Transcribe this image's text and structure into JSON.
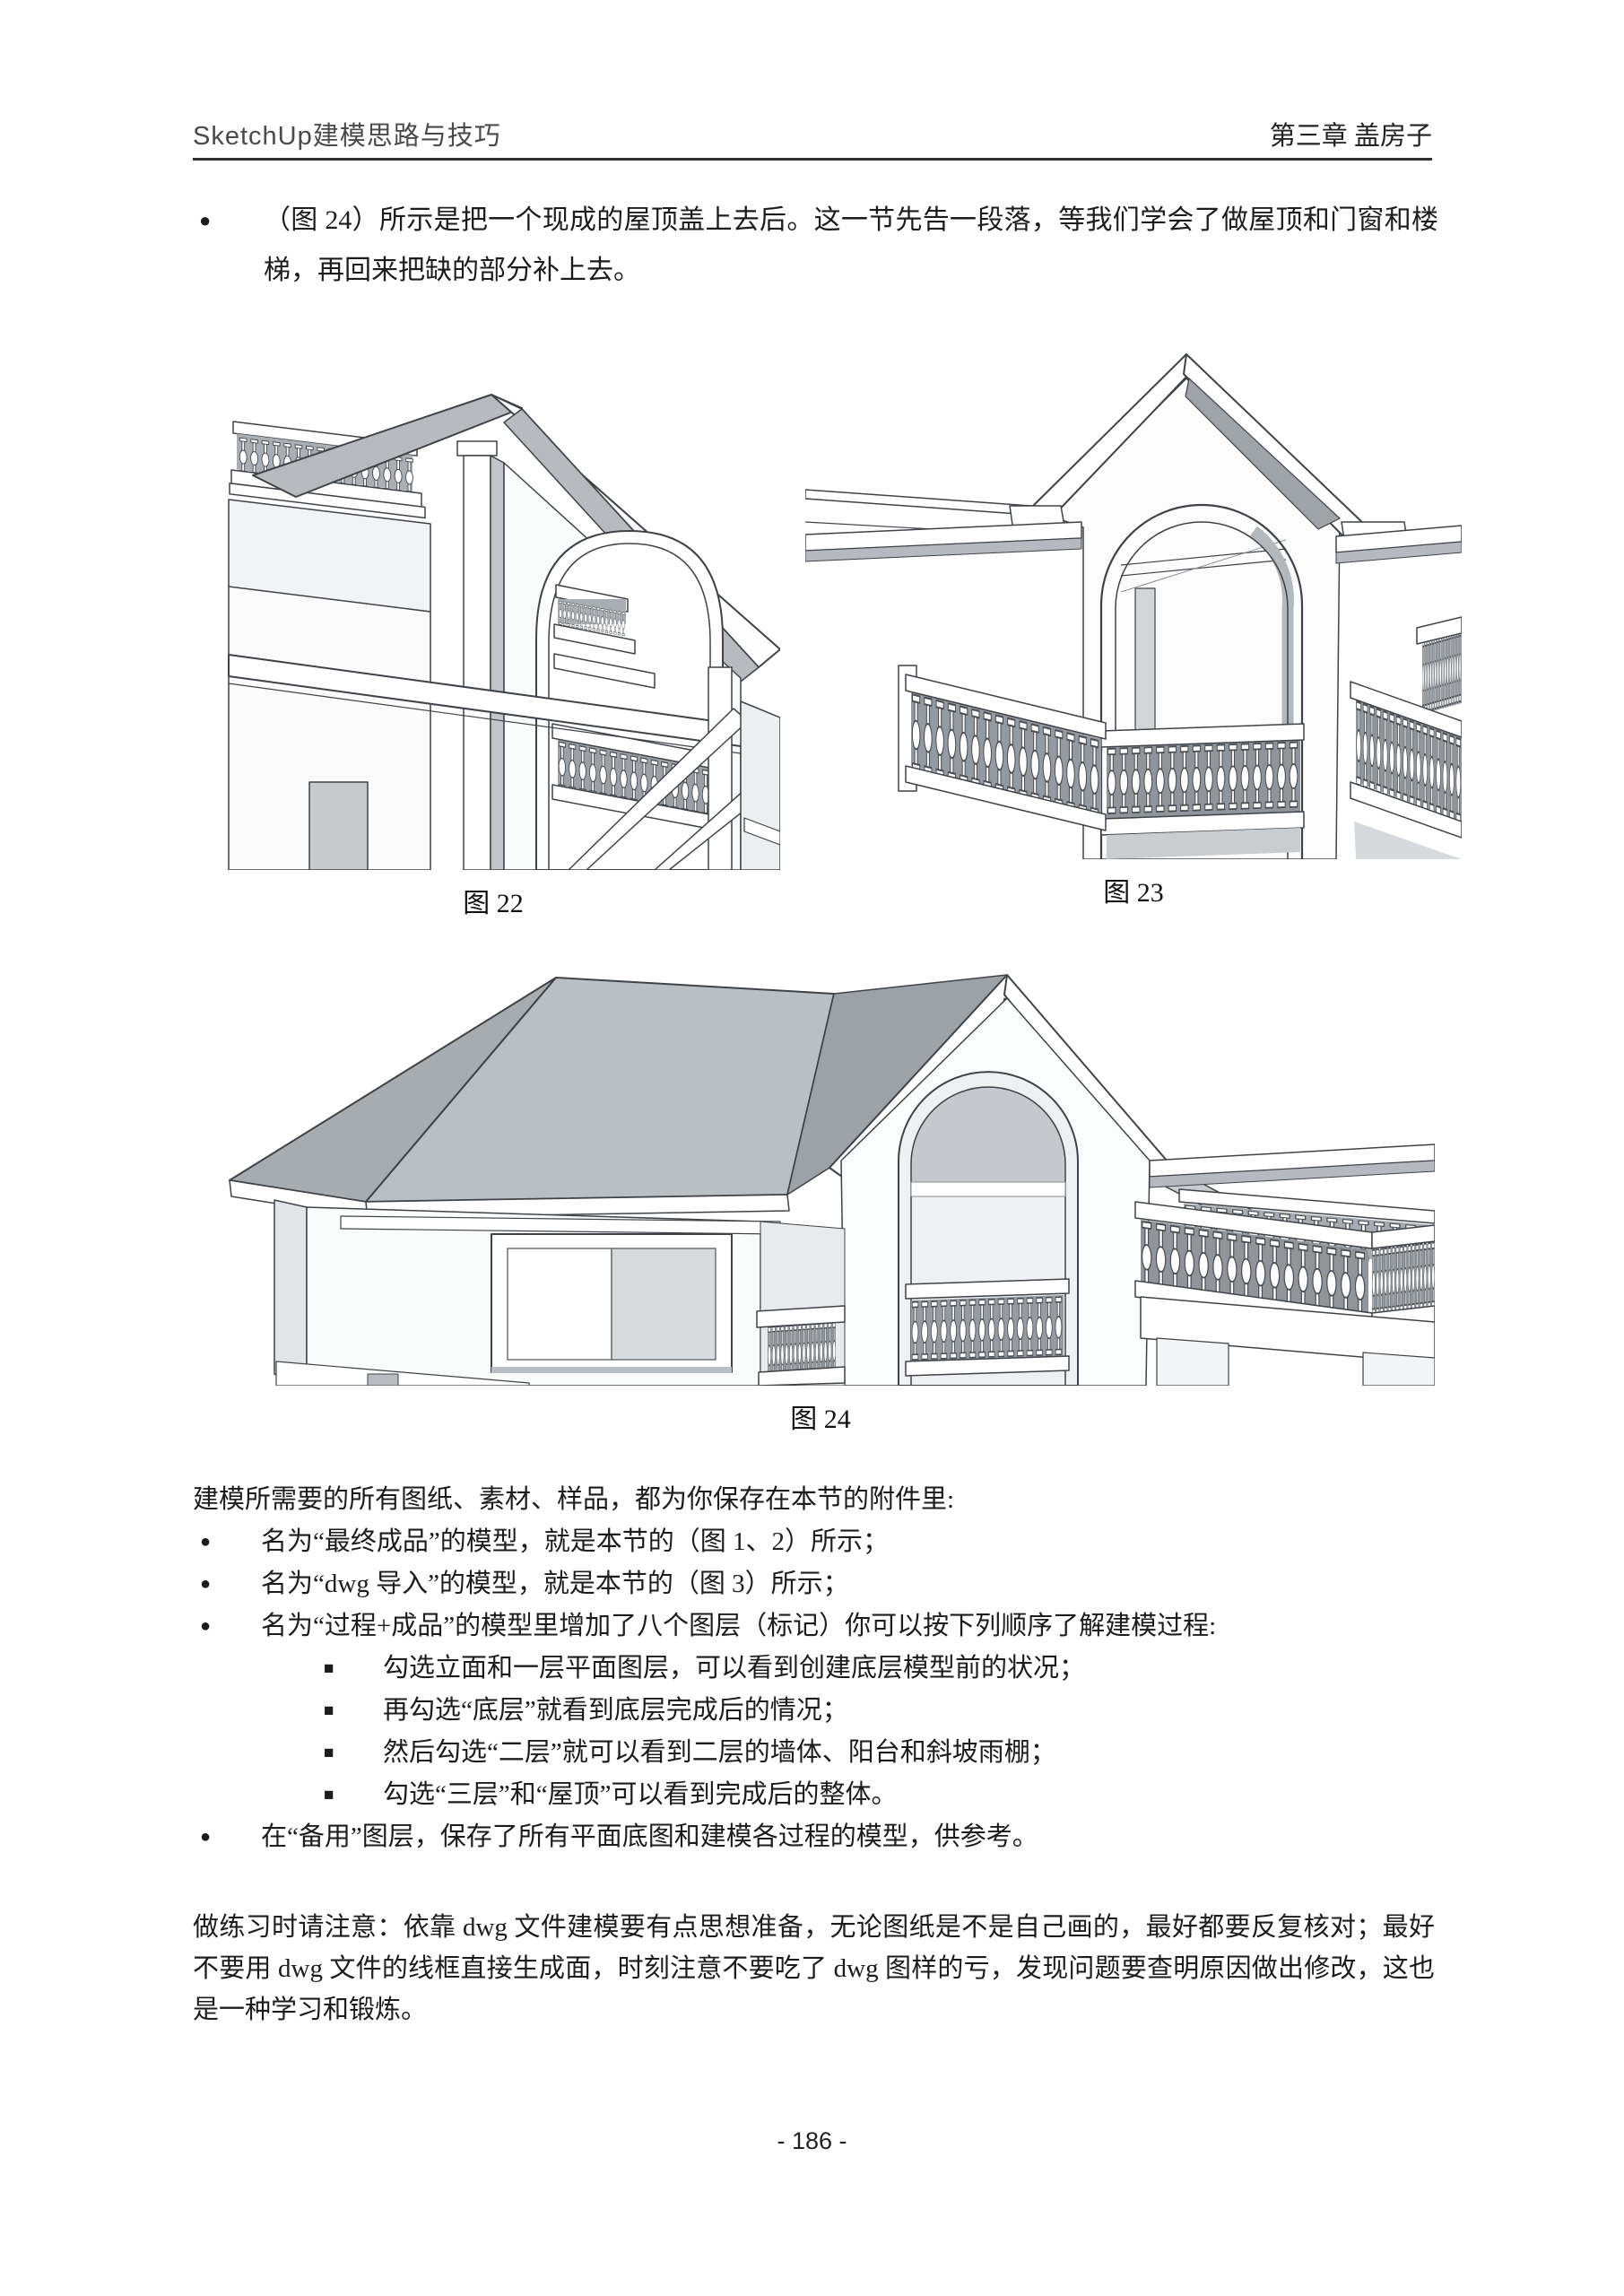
{
  "header": {
    "left_title": "SketchUp建模思路与技巧",
    "right_title": "第三章 盖房子"
  },
  "intro": {
    "marker": "●",
    "text": "（图 24）所示是把一个现成的屋顶盖上去后。这一节先告一段落，等我们学会了做屋顶和门窗和楼梯，再回来把缺的部分补上去。"
  },
  "figures": [
    {
      "caption": "图 22",
      "description": "SketchUp close-up of gable roof corner with arched opening, balcony balusters and sloped beams"
    },
    {
      "caption": "图 23",
      "description": "SketchUp front view of gable with large arched opening and balustrades"
    },
    {
      "caption": "图 24",
      "description": "SketchUp model of house with hip roof, gable with arch window and balconies"
    }
  ],
  "attachments": {
    "intro": "建模所需要的所有图纸、素材、样品，都为你保存在本节的附件里:",
    "items": [
      {
        "marker": "●",
        "text": "名为“最终成品”的模型，就是本节的（图 1、2）所示；"
      },
      {
        "marker": "●",
        "text": "名为“dwg 导入”的模型，就是本节的（图 3）所示；"
      },
      {
        "marker": "●",
        "text": "名为“过程+成品”的模型里增加了八个图层（标记）你可以按下列顺序了解建模过程:"
      },
      {
        "marker": "■",
        "text": "勾选立面和一层平面图层，可以看到创建底层模型前的状况；"
      },
      {
        "marker": "■",
        "text": "再勾选“底层”就看到底层完成后的情况；"
      },
      {
        "marker": "■",
        "text": "然后勾选“二层”就可以看到二层的墙体、阳台和斜坡雨棚；"
      },
      {
        "marker": "■",
        "text": "勾选“三层”和“屋顶”可以看到完成后的整体。"
      },
      {
        "marker": "●",
        "text": "在“备用”图层，保存了所有平面底图和建模各过程的模型，供参考。"
      }
    ]
  },
  "note": "做练习时请注意：依靠 dwg 文件建模要有点思想准备，无论图纸是不是自己画的，最好都要反复核对；最好不要用 dwg 文件的线框直接生成面，时刻注意不要吃了 dwg 图样的亏，发现问题要查明原因做出修改，这也是一种学习和锻炼。",
  "footer": {
    "page_number": "- 186 -"
  },
  "colors": {
    "rule": "#2f2f2f",
    "line": "#3f4348",
    "roof_gray": "#b7bbc0",
    "roof_dark": "#9da2a8",
    "baluster_backdrop": "#8f959b"
  }
}
